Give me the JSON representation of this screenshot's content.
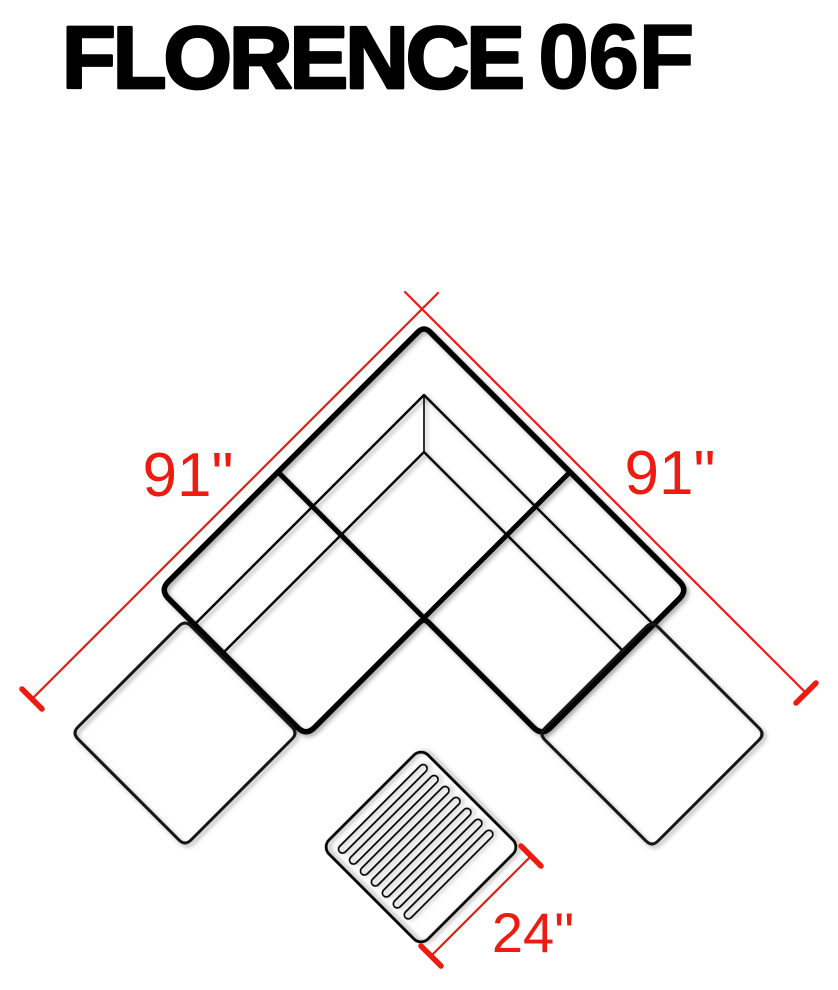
{
  "title": {
    "name": "FLORENCE",
    "model": "06F"
  },
  "dimensions": {
    "left_side": "91\"",
    "right_side": "91\"",
    "coffee_table": "24\""
  },
  "colors": {
    "line": "#000000",
    "dimension_red": "#ee1b10",
    "background": "#ffffff"
  }
}
